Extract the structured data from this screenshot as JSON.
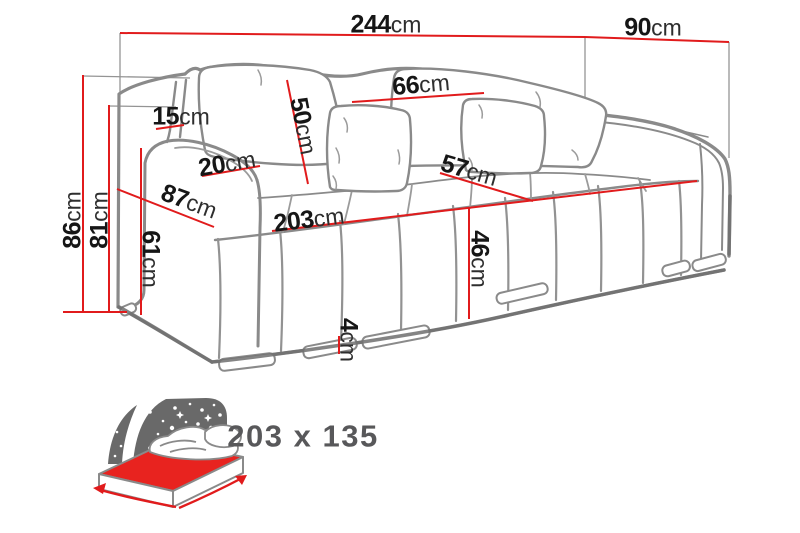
{
  "diagram": {
    "subject": "sofa-dimension-diagram",
    "unit": "cm"
  },
  "colors": {
    "dimension_line_red": "#e11b1c",
    "sketch_gray": "#8a8a8a",
    "shadow_gray": "#6f6f6f",
    "label_black": "#161616",
    "night_shape_gray": "#696969",
    "mattress_red": "#e8231f",
    "bed_label_gray": "#58585a",
    "background": "#ffffff"
  },
  "sofa_dimensions": {
    "total_width": {
      "value": "244",
      "unit": "cm"
    },
    "total_depth": {
      "value": "90",
      "unit": "cm"
    },
    "back_cushion_width": {
      "value": "66",
      "unit": "cm"
    },
    "back_cushion_height": {
      "value": "50",
      "unit": "cm"
    },
    "back_side_panel": {
      "value": "15",
      "unit": "cm"
    },
    "armrest_top_width": {
      "value": "20",
      "unit": "cm"
    },
    "side_depth": {
      "value": "87",
      "unit": "cm"
    },
    "total_height": {
      "value": "86",
      "unit": "cm"
    },
    "backrest_height": {
      "value": "81",
      "unit": "cm"
    },
    "armrest_height": {
      "value": "61",
      "unit": "cm"
    },
    "seat_length": {
      "value": "203",
      "unit": "cm"
    },
    "seat_depth": {
      "value": "57",
      "unit": "cm"
    },
    "seat_height": {
      "value": "46",
      "unit": "cm"
    },
    "leg_height": {
      "value": "4",
      "unit": "cm"
    }
  },
  "sleeping_area": {
    "size_label": "203 x 135"
  }
}
